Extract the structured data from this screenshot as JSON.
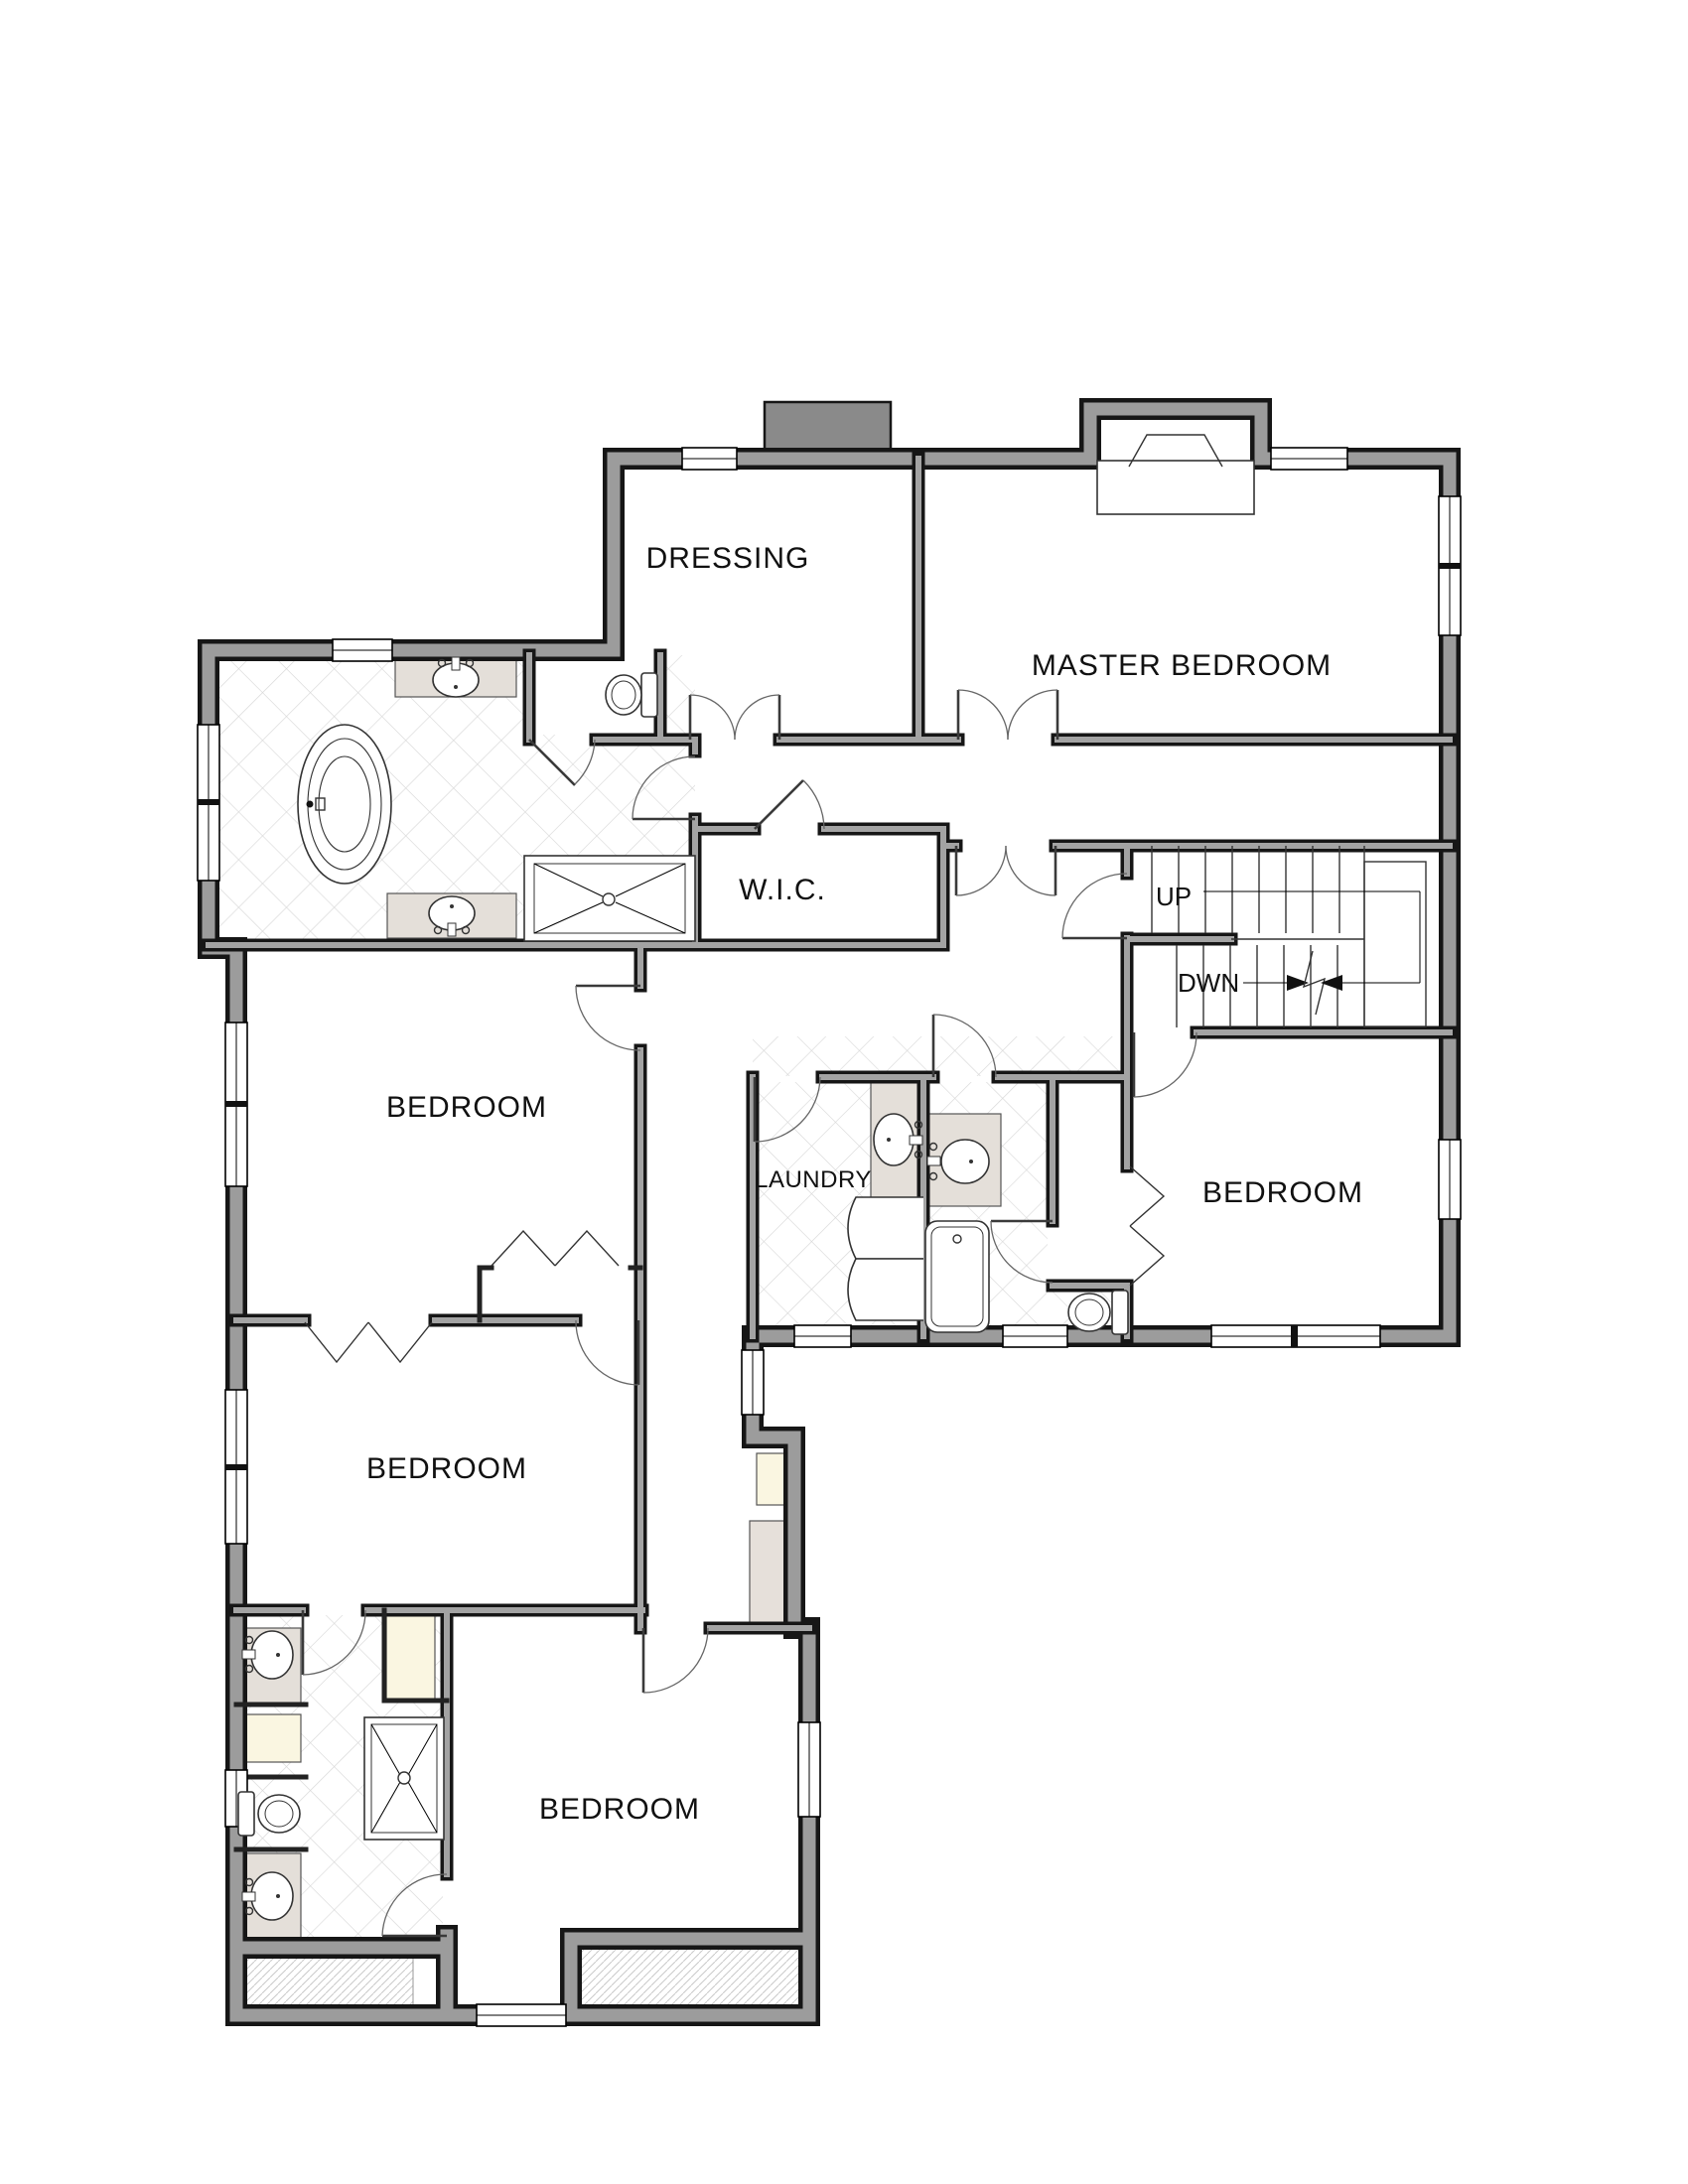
{
  "plan": {
    "rooms": {
      "dressing": "DRESSING",
      "master_bedroom": "MASTER BEDROOM",
      "wic": "W.I.C.",
      "laundry": "LAUNDRY",
      "bedroom_mid_left": "BEDROOM",
      "bedroom_right": "BEDROOM",
      "bedroom_lower_left": "BEDROOM",
      "bedroom_bottom": "BEDROOM"
    },
    "stairs": {
      "up_label": "UP",
      "down_label": "DWN"
    },
    "colors": {
      "wall_core": "#9c9c9c",
      "wall_edge": "#161616",
      "chimney": "#8a8a8a",
      "vanity_counter": "#e4dfd9",
      "closet_interior": "#faf6e1",
      "tile_line": "#d8d8d8",
      "hatch_line": "#c9c9c9"
    }
  }
}
